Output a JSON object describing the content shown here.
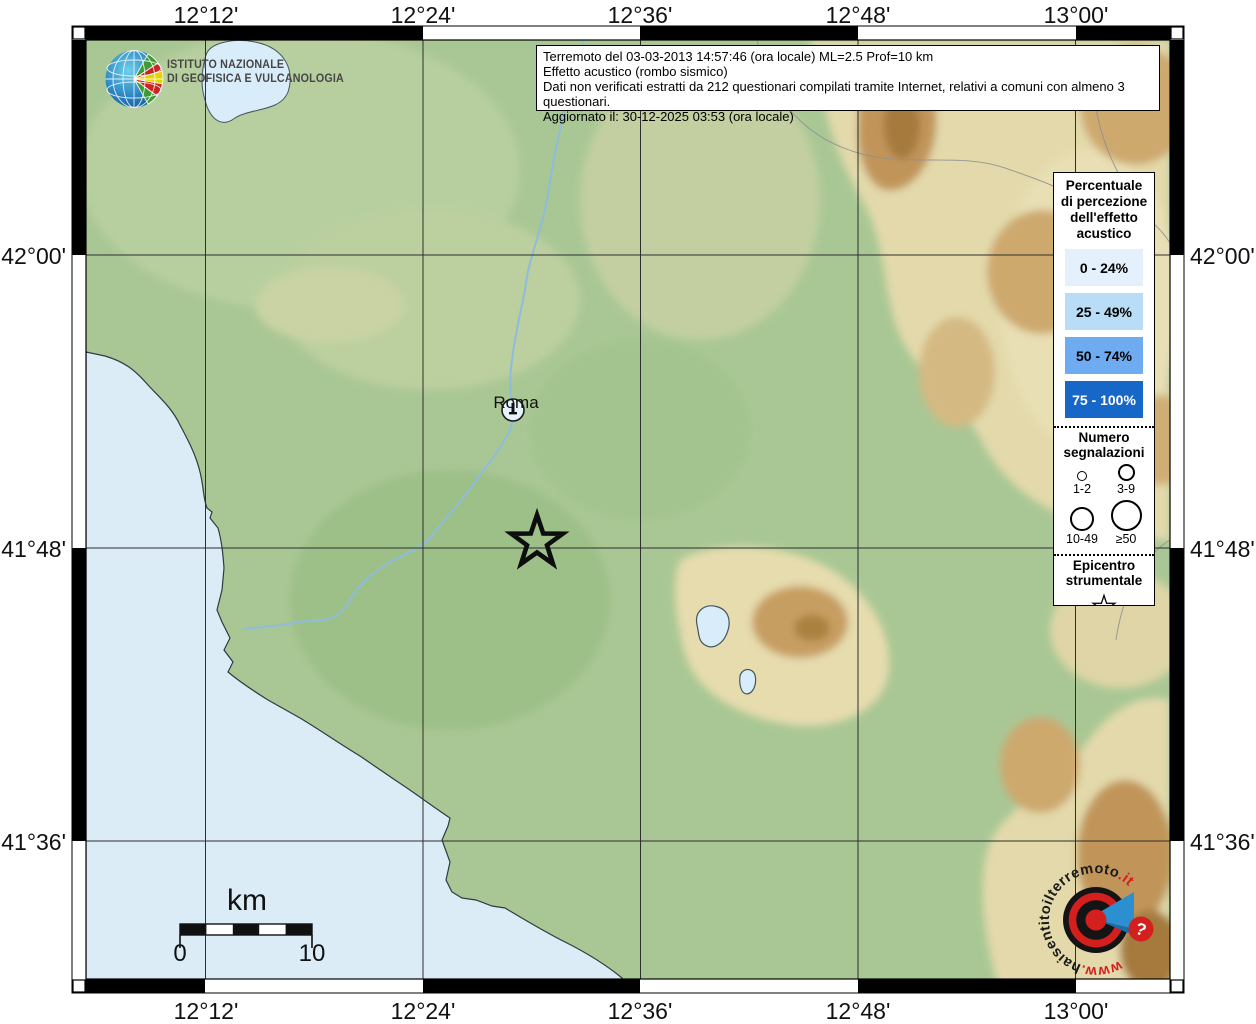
{
  "info_box": {
    "lines": [
      "Terremoto del 03-03-2013 14:57:46 (ora locale) ML=2.5 Prof=10 km",
      "Effetto acustico (rombo sismico)",
      "Dati non verificati estratti da 212 questionari compilati tramite Internet, relativi a comuni con almeno 3 questionari.",
      "Aggiornato il: 30-12-2025 03:53 (ora locale)"
    ]
  },
  "ingv_logo": {
    "line1": "ISTITUTO NAZIONALE",
    "line2": "DI GEOFISICA E VULCANOLOGIA"
  },
  "axes": {
    "top": [
      "12°12'",
      "12°24'",
      "12°36'",
      "12°48'",
      "13°00'"
    ],
    "bottom": [
      "12°12'",
      "12°24'",
      "12°36'",
      "12°48'",
      "13°00'"
    ],
    "left": [
      "42°00'",
      "41°48'",
      "41°36'"
    ],
    "right": [
      "42°00'",
      "41°48'",
      "41°36'"
    ]
  },
  "legend": {
    "title_lines": [
      "Percentuale",
      "di percezione",
      "dell'effetto",
      "acustico"
    ],
    "classes": [
      {
        "label": "0 - 24%",
        "color": "#e4f1fc",
        "text": "#000000"
      },
      {
        "label": "25 - 49%",
        "color": "#b9dcf7",
        "text": "#000000"
      },
      {
        "label": "50 - 74%",
        "color": "#6fabf1",
        "text": "#000000"
      },
      {
        "label": "75 - 100%",
        "color": "#1767c9",
        "text": "#ffffff"
      }
    ],
    "signals": {
      "title_lines": [
        "Numero",
        "segnalazioni"
      ],
      "items": [
        {
          "label": "1-2"
        },
        {
          "label": "3-9"
        },
        {
          "label": "10-49"
        },
        {
          "label": "≥50"
        }
      ]
    },
    "epicenter": {
      "title_lines": [
        "Epicentro",
        "strumentale"
      ]
    }
  },
  "scale_bar": {
    "unit": "km",
    "start_label": "0",
    "end_label": "10"
  },
  "map_labels": {
    "city": "Roma"
  },
  "watermark": {
    "prefix": "www.",
    "host": "haisentitoilterremoto",
    "tld": ".it",
    "question": "?"
  },
  "colors": {
    "sea": "#dcecf7",
    "land": "#a9c794",
    "highland": "#e3d9ab",
    "mountain": "#c1955a",
    "accent_red": "#d41f1f",
    "accent_blue": "#2b8fd0"
  }
}
